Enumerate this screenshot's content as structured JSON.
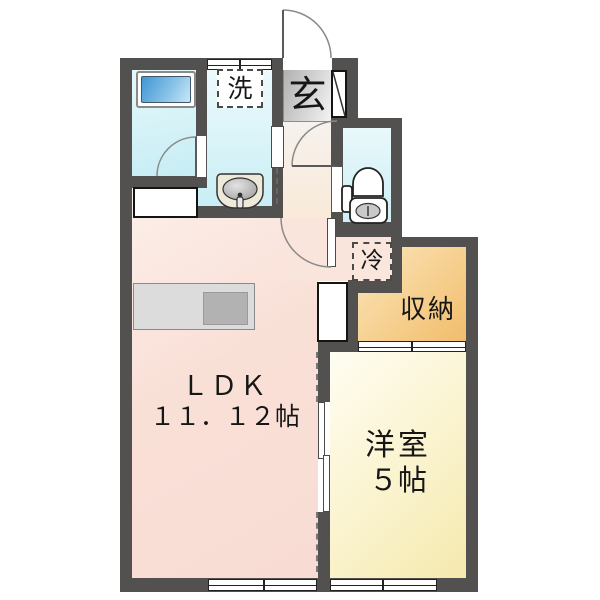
{
  "floor_plan": {
    "entrance": {
      "label": "玄"
    },
    "laundry_space": {
      "label": "洗"
    },
    "refrigerator_space": {
      "label": "冷"
    },
    "storage": {
      "label": "収納"
    },
    "ldk": {
      "label": "ＬＤＫ",
      "size": "１１．１２帖"
    },
    "western_room": {
      "label": "洋室",
      "size": "５帖"
    },
    "colors": {
      "wall": "#535050",
      "ldk_floor": "#f8ddd4",
      "hall_floor": "#f9ead9",
      "western_room_floor": "#f8f1c6",
      "storage_floor": "#f2c073",
      "wet_area_floor": "#cdeef5",
      "bathtub": "#55a3d6",
      "entrance_floor": "#c9c9c9"
    }
  }
}
